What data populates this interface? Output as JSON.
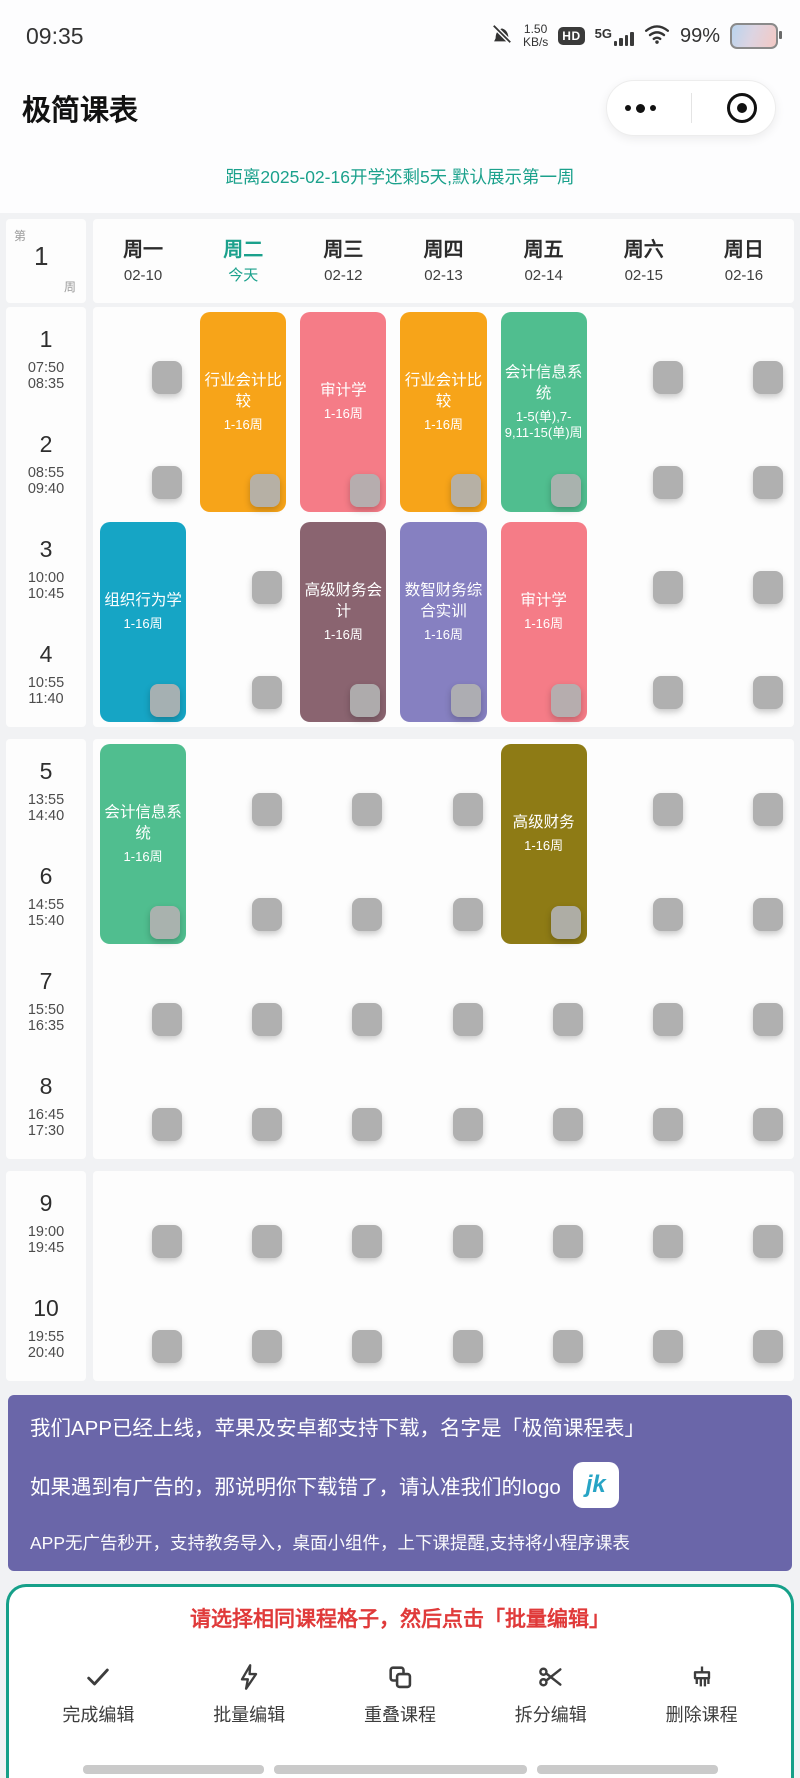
{
  "status_bar": {
    "time": "09:35",
    "net_speed": "1.50",
    "net_unit": "KB/s",
    "hd_badge": "HD",
    "network": "5G",
    "battery_percent": "99%"
  },
  "header": {
    "title": "极简课表"
  },
  "notice": {
    "text": "距离2025-02-16开学还剩5天,默认展示第一周"
  },
  "week_indicator": {
    "prefix": "第",
    "number": "1",
    "suffix": "周"
  },
  "schedule": {
    "days": [
      {
        "label": "周一",
        "sub": "02-10",
        "today": false
      },
      {
        "label": "周二",
        "sub": "今天",
        "today": true
      },
      {
        "label": "周三",
        "sub": "02-12",
        "today": false
      },
      {
        "label": "周四",
        "sub": "02-13",
        "today": false
      },
      {
        "label": "周五",
        "sub": "02-14",
        "today": false
      },
      {
        "label": "周六",
        "sub": "02-15",
        "today": false
      },
      {
        "label": "周日",
        "sub": "02-16",
        "today": false
      }
    ],
    "periods": [
      {
        "num": "1",
        "start": "07:50",
        "end": "08:35"
      },
      {
        "num": "2",
        "start": "08:55",
        "end": "09:40"
      },
      {
        "num": "3",
        "start": "10:00",
        "end": "10:45"
      },
      {
        "num": "4",
        "start": "10:55",
        "end": "11:40"
      },
      {
        "num": "5",
        "start": "13:55",
        "end": "14:40"
      },
      {
        "num": "6",
        "start": "14:55",
        "end": "15:40"
      },
      {
        "num": "7",
        "start": "15:50",
        "end": "16:35"
      },
      {
        "num": "8",
        "start": "16:45",
        "end": "17:30"
      },
      {
        "num": "9",
        "start": "19:00",
        "end": "19:45"
      },
      {
        "num": "10",
        "start": "19:55",
        "end": "20:40"
      }
    ],
    "sections": [
      [
        1,
        2,
        3,
        4
      ],
      [
        5,
        6,
        7,
        8
      ],
      [
        9,
        10
      ]
    ],
    "courses": [
      {
        "day": 1,
        "slot": 1,
        "span": 2,
        "name": "行业会计比较",
        "weeks": "1-16周",
        "color": "#f7a419"
      },
      {
        "day": 2,
        "slot": 1,
        "span": 2,
        "name": "审计学",
        "weeks": "1-16周",
        "color": "#f57c87"
      },
      {
        "day": 3,
        "slot": 1,
        "span": 2,
        "name": "行业会计比较",
        "weeks": "1-16周",
        "color": "#f7a419"
      },
      {
        "day": 4,
        "slot": 1,
        "span": 2,
        "name": "会计信息系统",
        "weeks": "1-5(单),7-9,11-15(单)周",
        "color": "#50be8f"
      },
      {
        "day": 0,
        "slot": 3,
        "span": 2,
        "name": "组织行为学",
        "weeks": "1-16周",
        "color": "#16a5c5"
      },
      {
        "day": 2,
        "slot": 3,
        "span": 2,
        "name": "高级财务会计",
        "weeks": "1-16周",
        "color": "#8a6470"
      },
      {
        "day": 3,
        "slot": 3,
        "span": 2,
        "name": "数智财务综合实训",
        "weeks": "1-16周",
        "color": "#8680c1"
      },
      {
        "day": 4,
        "slot": 3,
        "span": 2,
        "name": "审计学",
        "weeks": "1-16周",
        "color": "#f57c87"
      },
      {
        "day": 0,
        "slot": 5,
        "span": 2,
        "name": "会计信息系统",
        "weeks": "1-16周",
        "color": "#50be8f"
      },
      {
        "day": 4,
        "slot": 5,
        "span": 2,
        "name": "高级财务",
        "weeks": "1-16周",
        "color": "#8e7b15"
      }
    ]
  },
  "banner": {
    "line1": "我们APP已经上线，苹果及安卓都支持下载，名字是「极简课程表」",
    "line2": "如果遇到有广告的，那说明你下载错了，请认准我们的logo",
    "logo_text": "jk",
    "line3": "APP无广告秒开，支持教务导入，桌面小组件，上下课提醒,支持将小程序课表"
  },
  "edit_panel": {
    "instruction": "请选择相同课程格子，然后点击「批量编辑」",
    "buttons": [
      {
        "icon": "check-icon",
        "label": "完成编辑"
      },
      {
        "icon": "bolt-icon",
        "label": "批量编辑"
      },
      {
        "icon": "overlap-icon",
        "label": "重叠课程"
      },
      {
        "icon": "scissors-icon",
        "label": "拆分编辑"
      },
      {
        "icon": "broom-icon",
        "label": "删除课程"
      }
    ]
  },
  "colors": {
    "accent_teal": "#1ba18c",
    "banner_purple": "#6a66a9",
    "instruction_red": "#e03a3a",
    "checkbox_gray": "#b0b0b0"
  }
}
